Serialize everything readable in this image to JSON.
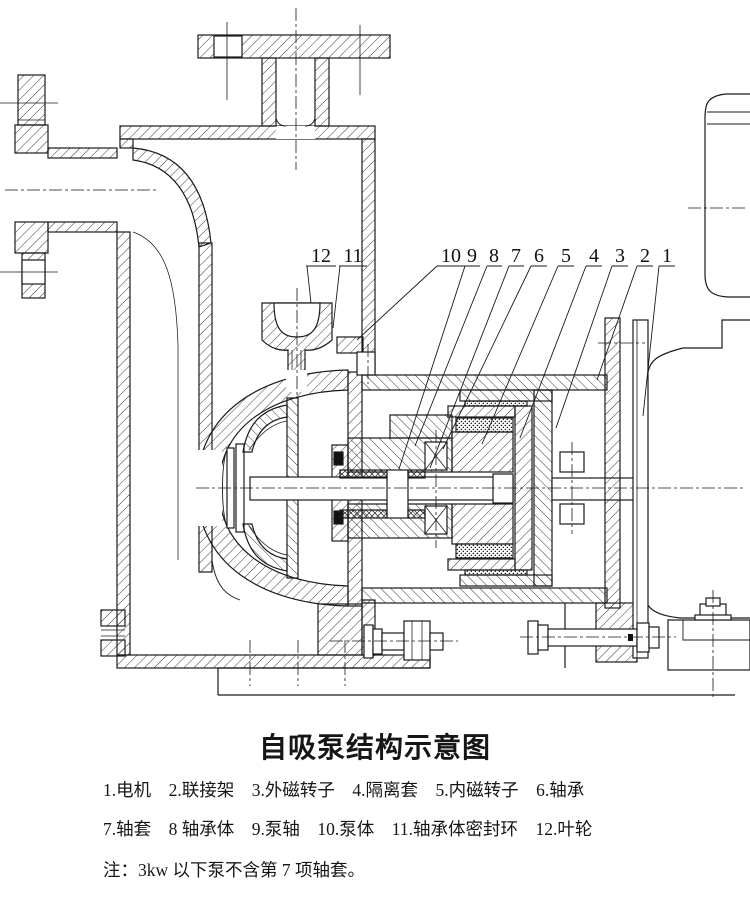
{
  "colors": {
    "line": "#1a1a1a",
    "background": "#ffffff"
  },
  "drawing": {
    "description": "cross-section of self-priming magnetic pump",
    "callouts": [
      "12",
      "11",
      "10",
      "9",
      "8",
      "7",
      "6",
      "5",
      "4",
      "3",
      "2",
      "1"
    ]
  },
  "caption": {
    "title": "自吸泵结构示意图",
    "legend_row1": [
      "1.电机",
      "2.联接架",
      "3.外磁转子",
      "4.隔离套",
      "5.内磁转子",
      "6.轴承"
    ],
    "legend_row2": [
      "7.轴套",
      "8 轴承体",
      "9.泵轴",
      "10.泵体",
      "11.轴承体密封环",
      "12.叶轮"
    ],
    "note": "注：3kw 以下泵不含第 7 项轴套。"
  }
}
